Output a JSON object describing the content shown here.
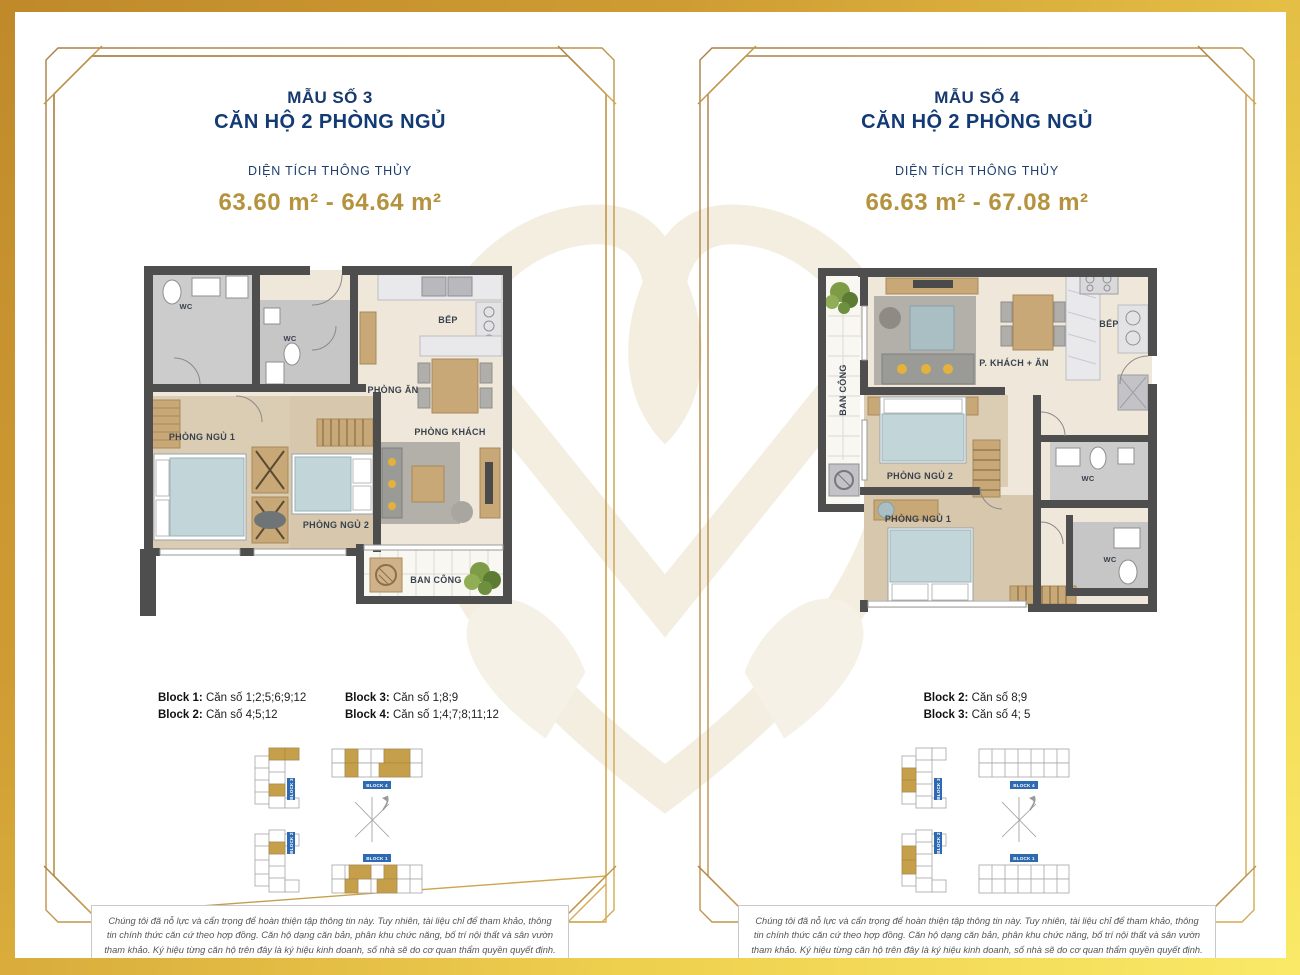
{
  "page": {
    "accent_navy": "#17396f",
    "accent_gold": "#b5923d",
    "frame_gold": "#b5874a",
    "band_gradient": [
      "#c08a2b",
      "#f9e966"
    ]
  },
  "panels": [
    {
      "template_label": "MẪU SỐ 3",
      "title": "CĂN HỘ 2 PHÒNG NGỦ",
      "area_label": "DIỆN TÍCH THÔNG THỦY",
      "area_value": "63.60 m² - 64.64 m²",
      "rooms": {
        "wc1": "WC",
        "wc2": "WC",
        "kitchen": "BẾP",
        "dining": "PHÒNG ĂN",
        "living": "PHÒNG KHÁCH",
        "bedroom1": "PHÒNG NGỦ 1",
        "bedroom2": "PHÒNG NGỦ 2",
        "balcony": "BAN CÔNG"
      },
      "blocks": [
        {
          "name": "Block 1:",
          "units": "Căn số 1;2;5;6;9;12"
        },
        {
          "name": "Block 2:",
          "units": "Căn số 4;5;12"
        },
        {
          "name": "Block 3:",
          "units": "Căn số 1;8;9"
        },
        {
          "name": "Block 4:",
          "units": "Căn số 1;4;7;8;11;12"
        }
      ],
      "keyplan": {
        "labels": [
          "BLOCK 3",
          "BLOCK 4",
          "BLOCK 2",
          "BLOCK 1"
        ]
      },
      "disclaimer": "Chúng tôi đã nỗ lực và cẩn trọng để hoàn thiện tập thông tin này. Tuy nhiên, tài liệu chỉ để tham khảo, thông tin chính thức căn cứ theo hợp đồng. Căn hộ dạng căn bản, phân khu chức năng, bố trí nội thất và sân vườn tham khảo. Ký hiệu từng căn hộ trên đây là ký hiệu kinh doanh, số nhà sẽ do cơ quan thẩm quyền quyết định."
    },
    {
      "template_label": "MẪU SỐ 4",
      "title": "CĂN HỘ 2 PHÒNG NGỦ",
      "area_label": "DIỆN TÍCH THÔNG THỦY",
      "area_value": "66.63 m² - 67.08 m²",
      "rooms": {
        "balcony": "BAN CÔNG",
        "living_dining": "P. KHÁCH + ĂN",
        "kitchen": "BẾP",
        "bedroom2": "PHÒNG NGỦ 2",
        "bedroom1": "PHÒNG NGỦ 1",
        "wc1": "WC",
        "wc2": "WC"
      },
      "blocks": [
        {
          "name": "Block 2:",
          "units": "Căn số 8;9"
        },
        {
          "name": "Block 3:",
          "units": "Căn số 4; 5"
        }
      ],
      "keyplan": {
        "labels": [
          "BLOCK 3",
          "BLOCK 4",
          "BLOCK 2",
          "BLOCK 1"
        ]
      },
      "disclaimer": "Chúng tôi đã nỗ lực và cẩn trọng để hoàn thiện tập thông tin này. Tuy nhiên, tài liệu chỉ để tham khảo, thông tin chính thức căn cứ theo hợp đồng. Căn hộ dạng căn bản, phân khu chức năng, bố trí nội thất và sân vườn tham khảo. Ký hiệu từng căn hộ trên đây là ký hiệu kinh doanh, số nhà sẽ do cơ quan thẩm quyền quyết định."
    }
  ]
}
